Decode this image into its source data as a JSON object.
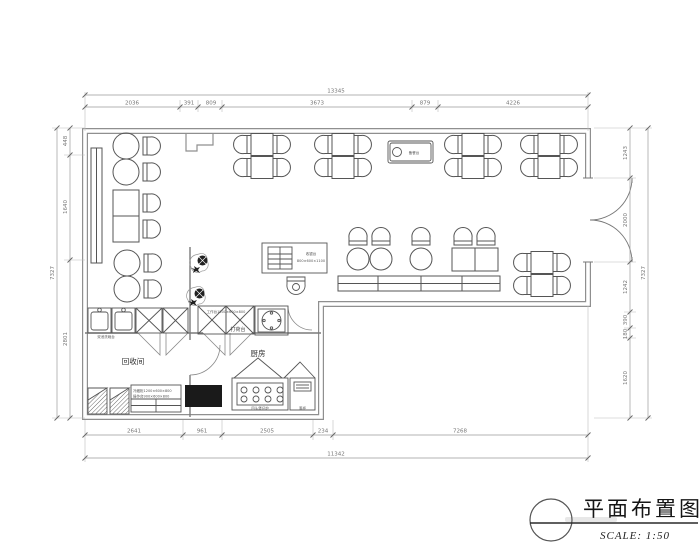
{
  "title_block": {
    "title": "平面布置图",
    "scale_label": "SCALE: 1:50"
  },
  "room_labels": {
    "recycle_room": "回收间",
    "kitchen": "厨房",
    "pass_counter": "打荷台",
    "service_station": "备餐台"
  },
  "equipment_labels": {
    "sink": "双池洗碗台",
    "worktop": "工作台1500×600×800",
    "cold_cabinet": "冷藏柜1200×600×800",
    "prep_table": "操作台900×600×800",
    "stove": "四头煲仔炉",
    "steam_cabinet": "蒸柜",
    "bar_line1": "收银台",
    "bar_line2": "800×600×1100"
  },
  "dimensions": {
    "top_total": "13345",
    "top_segments": [
      "2036",
      "391",
      "809",
      "3673",
      "879",
      "4226"
    ],
    "bottom_total": "11342",
    "bottom_segments": [
      "2641",
      "961",
      "2505",
      "234",
      "7268"
    ],
    "left_total": "7327",
    "left_segments": [
      "448",
      "1640",
      "2801"
    ],
    "right_total": "7327",
    "right_segments": [
      "1243",
      "2000",
      "1242",
      "390",
      "180",
      "1620"
    ]
  }
}
